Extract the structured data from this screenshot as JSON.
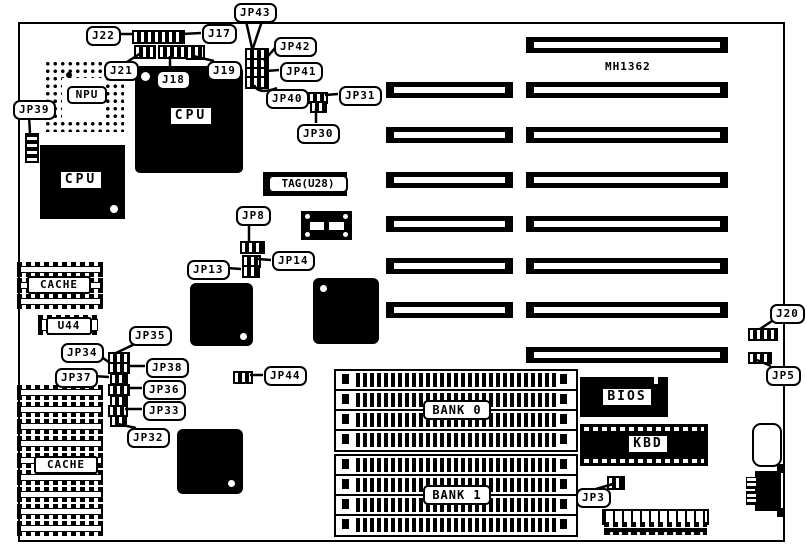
{
  "board": {
    "part_number": "MH1362"
  },
  "processors": {
    "npu_socket": "NPU",
    "cpu_upper": "CPU",
    "cpu_lower": "CPU"
  },
  "memory": {
    "cache_upper": "CACHE",
    "u44": "U44",
    "cache_lower": "CACHE",
    "tag": "TAG(U28)",
    "bank0": "BANK 0",
    "bank1": "BANK 1"
  },
  "chips": {
    "bios": "BIOS",
    "kbd": "KBD"
  },
  "callouts": {
    "jp43": "JP43",
    "j22": "J22",
    "j17": "J17",
    "j21": "J21",
    "j18": "J18",
    "j19": "J19",
    "jp42": "JP42",
    "jp41": "JP41",
    "jp40": "JP40",
    "jp31": "JP31",
    "jp30": "JP30",
    "jp39": "JP39",
    "jp8": "JP8",
    "jp13": "JP13",
    "jp14": "JP14",
    "jp35": "JP35",
    "jp34": "JP34",
    "jp38": "JP38",
    "jp37": "JP37",
    "jp36": "JP36",
    "jp33": "JP33",
    "jp32": "JP32",
    "jp44": "JP44",
    "j20": "J20",
    "jp5": "JP5",
    "jp3": "JP3"
  },
  "colors": {
    "ink": "#000000",
    "paper": "#ffffff"
  }
}
